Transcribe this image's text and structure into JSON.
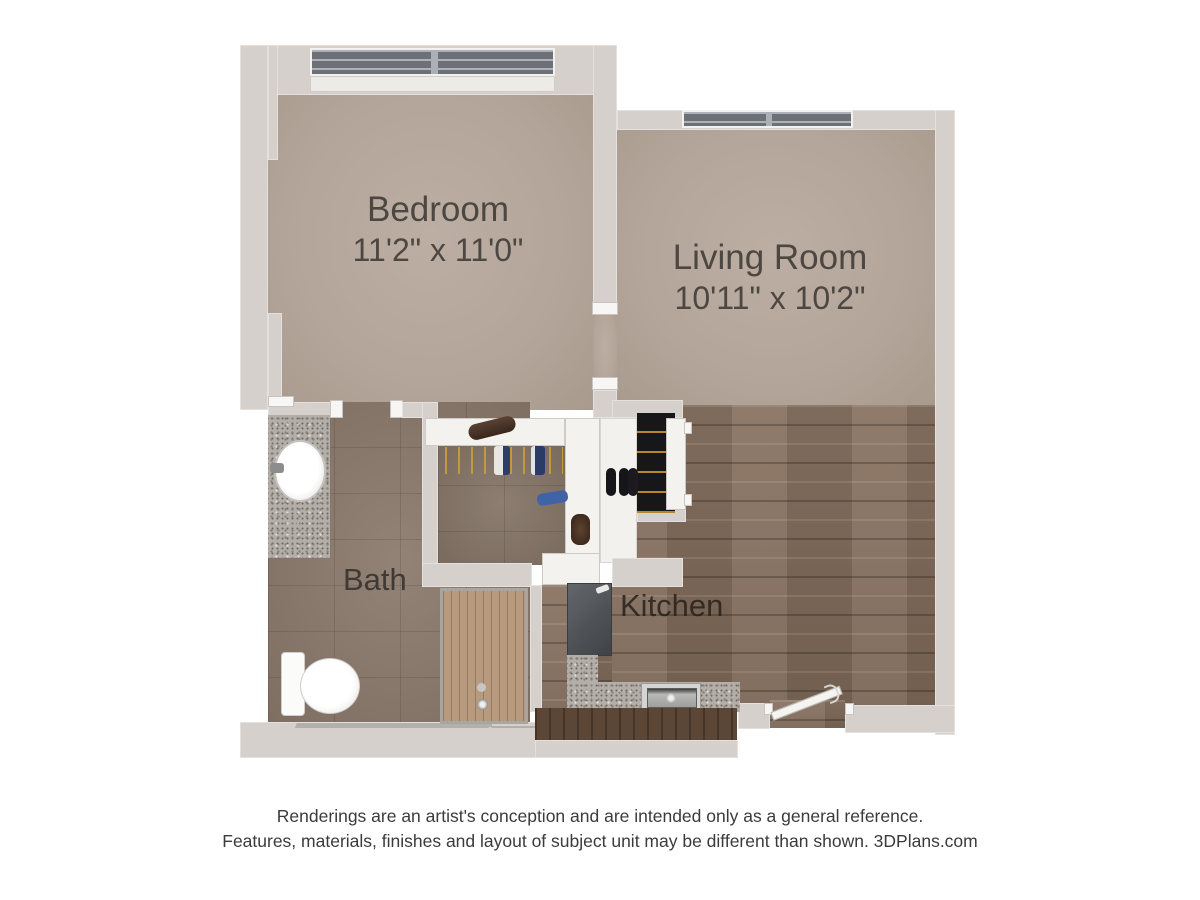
{
  "plan": {
    "title": "One bedroom apartment 3D floor plan",
    "rooms": [
      {
        "name": "Bedroom",
        "dimensions": "11'2\" x 11'0\""
      },
      {
        "name": "Living Room",
        "dimensions": "10'11\" x 10'2\""
      },
      {
        "name": "Bath",
        "dimensions": ""
      },
      {
        "name": "Kitchen",
        "dimensions": ""
      }
    ],
    "fixtures": [
      "bedroom-window",
      "living-room-window",
      "vanity-sink",
      "toilet",
      "towel-bar",
      "shower",
      "closet-shelf",
      "hanging-clothes",
      "shoes",
      "wardrobe",
      "wardrobe-door",
      "range-appliance",
      "kitchen-counter",
      "kitchen-sink",
      "base-cabinets",
      "entry-door"
    ],
    "colors": {
      "wall": "#d5d0cb",
      "carpet": "#b7a99e",
      "bath_tile": "#8c7b6d",
      "wood_floor": "#85705f",
      "shower_wood": "#b89b7f",
      "granite": "#b3aea8",
      "window_glass": "#6c7178",
      "wardrobe_interior": "#17171a",
      "label_text": "#4d4741"
    }
  },
  "footer": {
    "line1": "Renderings are an artist's conception and are intended only as a general reference.",
    "line2": "Features, materials, finishes and layout of subject unit may be different than shown. 3DPlans.com"
  }
}
